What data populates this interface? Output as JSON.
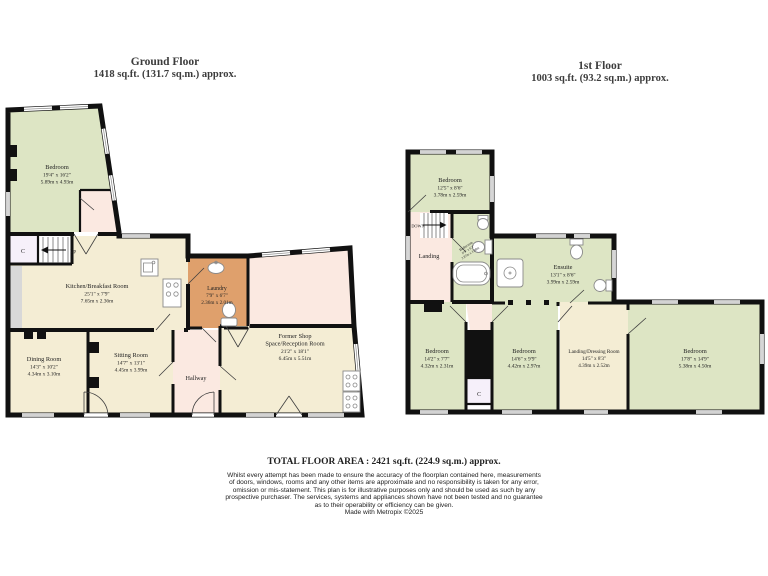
{
  "ground_floor": {
    "title": "Ground Floor",
    "subtitle": "1418 sq.ft. (131.7 sq.m.) approx.",
    "rooms": {
      "bedroom": {
        "name": "Bedroom",
        "ft": "19'4\" x 16'2\"",
        "m": "5.89m x 4.93m"
      },
      "kitchen": {
        "name": "Kitchen/Breakfast Room",
        "ft": "25'1\" x 7'9\"",
        "m": "7.65m x 2.36m"
      },
      "laundry": {
        "name": "Laundry",
        "ft": "7'9\" x 6'7\"",
        "m": "2.36m x 2.01m"
      },
      "dining": {
        "name": "Dining Room",
        "ft": "14'3\" x 10'2\"",
        "m": "4.34m x 3.10m"
      },
      "sitting": {
        "name": "Sitting Room",
        "ft": "14'7\" x 13'1\"",
        "m": "4.45m x 3.99m"
      },
      "hallway": {
        "name": "Hallway"
      },
      "shop": {
        "name1": "Former Shop",
        "name2": "Space/Reception Room",
        "ft": "21'2\" x 18'1\"",
        "m": "6.45m x 5.51m"
      },
      "closet": {
        "label": "C"
      },
      "stairs": {
        "label": "Up"
      }
    }
  },
  "first_floor": {
    "title": "1st Floor",
    "subtitle": "1003 sq.ft. (93.2 sq.m.) approx.",
    "rooms": {
      "bedroom_top": {
        "name": "Bedroom",
        "ft": "12'5\" x 8'6\"",
        "m": "3.78m x 2.59m"
      },
      "landing": {
        "name": "Landing"
      },
      "bathroom": {
        "name": "Bathroom",
        "ft": "9'5\" x 6'2\"",
        "m": "2.87m x 1.88m"
      },
      "ensuite": {
        "name": "Ensuite",
        "ft": "13'1\" x 8'6\"",
        "m": "3.99m x 2.59m"
      },
      "bedroom_left": {
        "name": "Bedroom",
        "ft": "14'2\" x 7'7\"",
        "m": "4.32m x 2.31m"
      },
      "bedroom_mid": {
        "name": "Bedroom",
        "ft": "14'6\" x 9'9\"",
        "m": "4.42m x 2.97m"
      },
      "dressing": {
        "name": "Landing/Dressing Room",
        "ft": "14'5\" x 8'3\"",
        "m": "4.39m x 2.52m"
      },
      "bedroom_right": {
        "name": "Bedroom",
        "ft": "17'8\" x 14'9\"",
        "m": "5.38m x 4.50m"
      },
      "closet": {
        "label": "C"
      },
      "stairs": {
        "label": "DOWN"
      }
    }
  },
  "footer": {
    "total": "TOTAL FLOOR AREA : 2421 sq.ft. (224.9 sq.m.) approx.",
    "lines": [
      "Whilst every attempt has been made to ensure the accuracy of the floorplan contained here, measurements",
      "of doors, windows, rooms and any other items are approximate and no responsibility is taken for any error,",
      "omission or mis-statement. This plan is for illustrative purposes only and should be used as such by any",
      "prospective purchaser. The services, systems and appliances shown have not been tested and no guarantee",
      "as to their operability or efficiency can be given."
    ],
    "credit": "Made with Metropix ©2025"
  },
  "colors": {
    "room_green": "#dde5c4",
    "room_beige": "#f4edd4",
    "room_pink": "#fbe9e1",
    "room_orange": "#dfa06c",
    "room_closet": "#f6f0fa",
    "counter_gray": "#d8d8d8",
    "wall": "#111111",
    "label_color": "#232323"
  }
}
